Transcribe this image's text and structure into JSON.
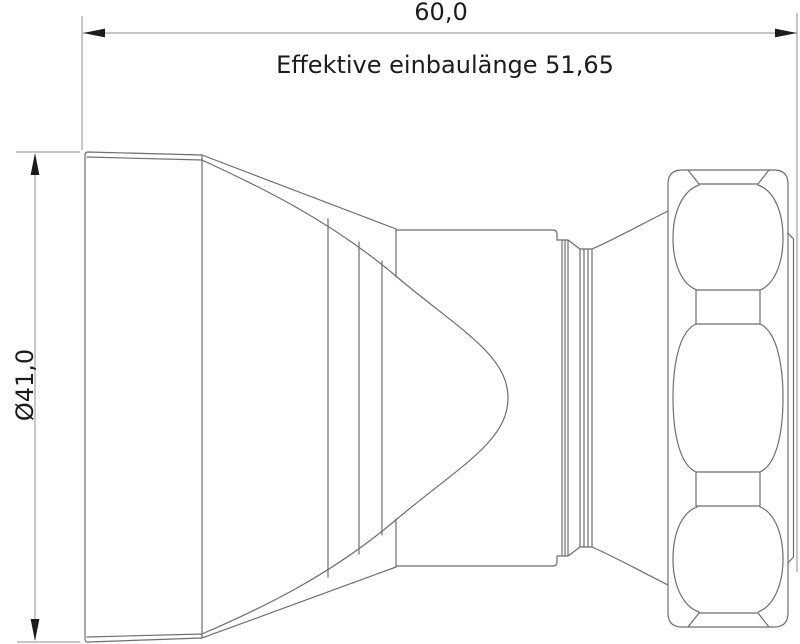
{
  "drawing": {
    "type": "technical-drawing",
    "view": "side-view-horn-connector",
    "dimensions": {
      "overall_length": "60,0",
      "effective_length_label": "Effektive einbaulänge 51,65",
      "diameter": "Ø41,0"
    },
    "colors": {
      "bg": "#ffffff",
      "part_line": "#6e6e6e",
      "dim_line": "#8f8f8f",
      "ink": "#1c1c1c"
    }
  }
}
